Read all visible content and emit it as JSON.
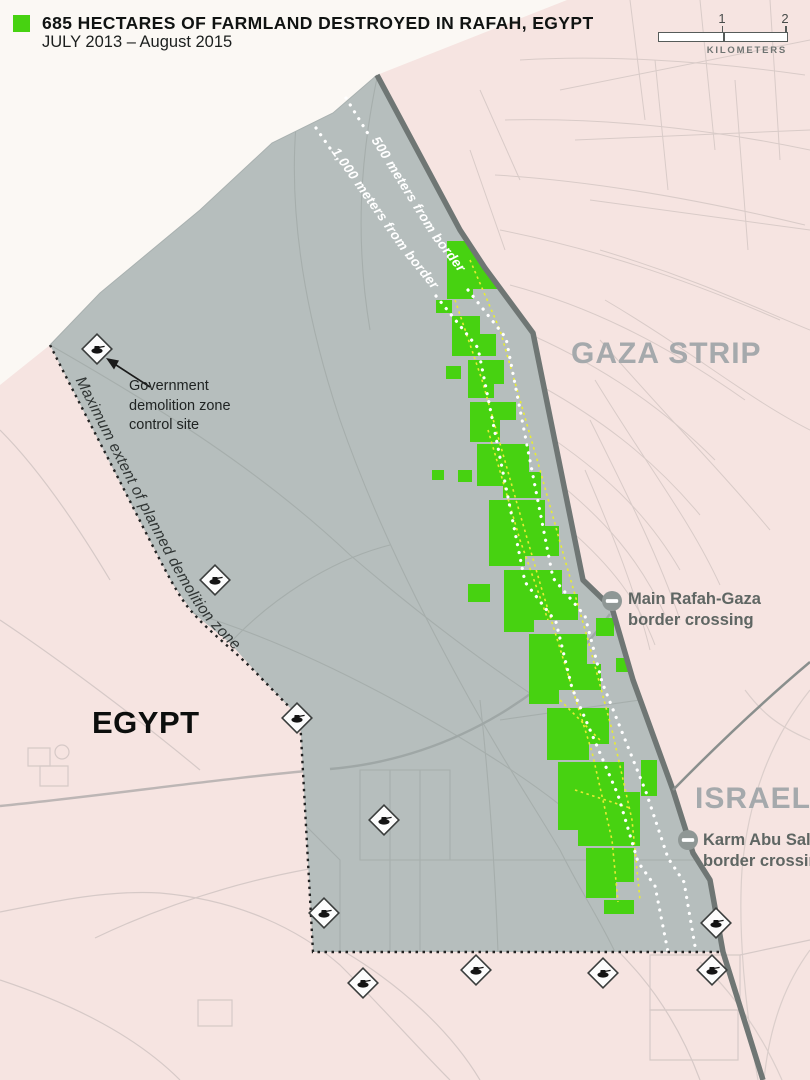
{
  "header": {
    "title": "685 HECTARES OF FARMLAND DESTROYED IN RAFAH, EGYPT",
    "subtitle": "JULY 2013 – August 2015"
  },
  "scale_bar": {
    "tick_1": "1",
    "tick_2": "2",
    "unit": "KILOMETERS"
  },
  "map": {
    "region_labels": {
      "gaza": "GAZA STRIP",
      "israel": "ISRAEL",
      "egypt": "EGYPT"
    },
    "annotations": {
      "control_site": "Government demolition zone control site",
      "line_500m": "500 meters from border",
      "line_1000m": "1,000 meters from border",
      "max_extent": "Maximum extent of planned demolition zone",
      "main_crossing": "Main Rafah-Gaza border crossing",
      "karm_crossing": "Karm Abu Salem border crossing"
    },
    "colors": {
      "farmland_green": "#47d211",
      "demolition_zone_gray": "#b6bebd",
      "land_pink": "#f6e4e1",
      "sea_white": "#fbf8f4",
      "border_dark": "#6f7674",
      "farm_road_yellow": "#e8ec33",
      "distance_line_white": "#ffffff",
      "extent_line_black": "#222222"
    }
  }
}
